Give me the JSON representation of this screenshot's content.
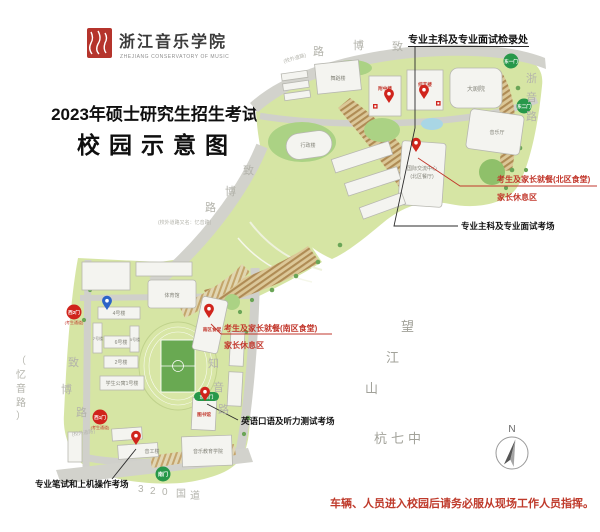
{
  "header": {
    "logo_cn": "浙江音乐学院",
    "logo_en": "ZHEJIANG CONSERVATORY OF MUSIC",
    "title_line1": "2023年硕士研究生招生考试",
    "title_line2": "校园示意图"
  },
  "annotations": {
    "checkin": "专业主科及专业面试检录处",
    "interview_exam": "专业主科及专业面试考场",
    "north_dining": "考生及家长就餐(北区食堂)",
    "north_rest": "家长休息区",
    "south_dining": "考生及家长就餐(南区食堂)",
    "south_rest": "家长休息区",
    "english_exam": "英语口语及听力测试考场",
    "written_exam": "专业笔试和上机操作考场",
    "footer_note": "车辆、人员进入校园后请务必服从现场工作人员指挥。"
  },
  "buildings": {
    "wudao": "舞蹈楼",
    "fuzhong": "附中楼",
    "zongyi": "综艺楼",
    "dajuyuan": "大剧院",
    "yinyueting": "音乐厅",
    "guoji_line1": "国际交流中心",
    "guoji_line2": "(北区餐厅)",
    "xingzheng": "行政楼",
    "tiyuguan": "体育馆",
    "nanqu_shitang": "南区食堂",
    "b4": "4号楼",
    "b7": "7号楼",
    "b6": "6号楼",
    "b5": "5号楼",
    "b2": "2号楼",
    "dorm1": "学生公寓1号楼",
    "tushuguan": "图书馆",
    "yinyuejiaoyu": "音乐教育学院",
    "yingong": "音工楼"
  },
  "gates": {
    "east1": "东一门",
    "east2": "东二门",
    "southeast": "东南门",
    "south": "南门",
    "west1": "西1门",
    "west2": "西2门",
    "west_note": "(考生通道)"
  },
  "roads": {
    "zhibo": [
      "致",
      "博",
      "路"
    ],
    "zheyin": [
      "浙",
      "音",
      "路"
    ],
    "zhiyin": [
      "知",
      "音",
      "路"
    ],
    "yiyin": [
      "（",
      "忆",
      "音",
      "路",
      "）"
    ],
    "g320": [
      "3",
      "2",
      "0",
      "国",
      "道"
    ],
    "outside_note": "(校外道路)",
    "outside_alias": "(校外道路又名：忆音路)"
  },
  "places": {
    "wangjiang": [
      "望",
      "江",
      "山"
    ],
    "hangqizhong": "杭七中",
    "compass_n": "N"
  }
}
